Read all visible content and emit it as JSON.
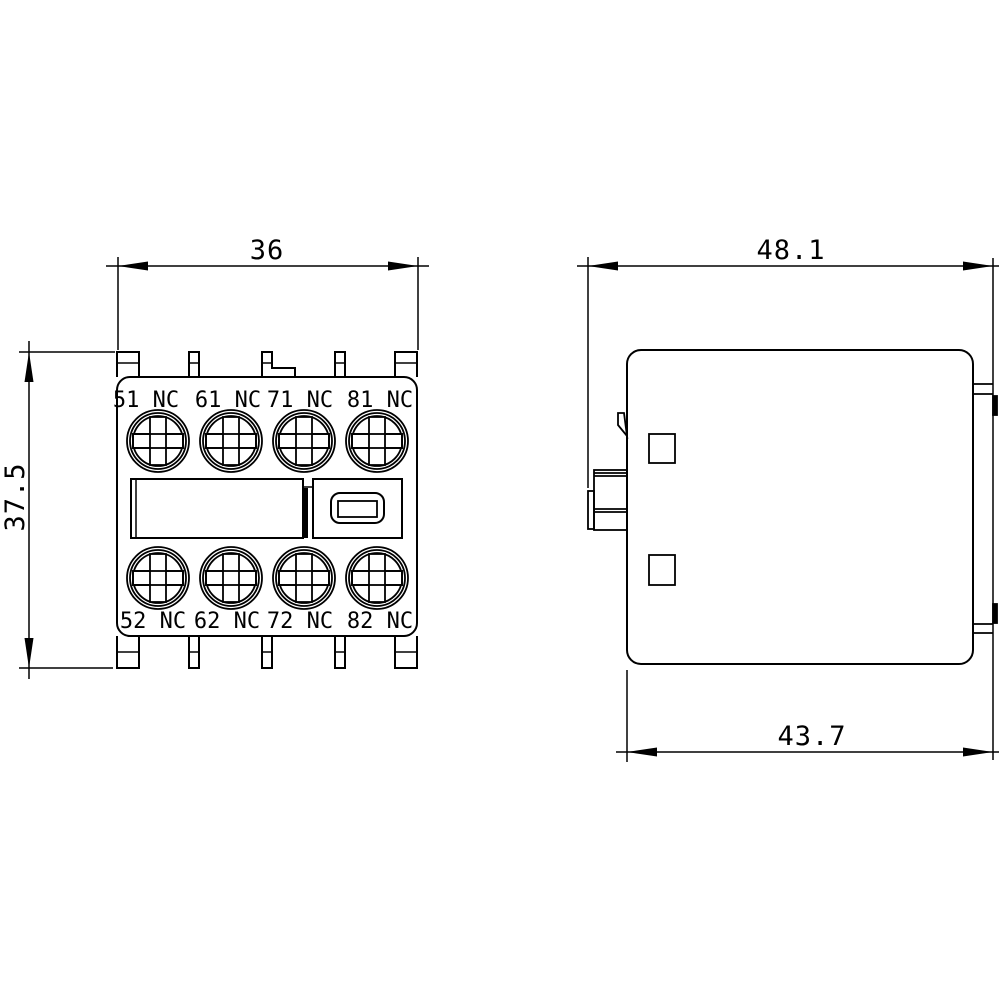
{
  "drawing_type": "dimensional-drawing",
  "colors": {
    "line": "#000000",
    "background": "#ffffff",
    "arrow_fill": "#000000"
  },
  "front_view": {
    "dim_width": "36",
    "dim_height": "37.5",
    "terminals_top": [
      "51 NC",
      "61 NC",
      "71 NC",
      "81 NC"
    ],
    "terminals_bottom": [
      "52 NC",
      "62 NC",
      "72 NC",
      "82 NC"
    ]
  },
  "side_view": {
    "dim_width_total": "48.1",
    "dim_width_body": "43.7"
  }
}
